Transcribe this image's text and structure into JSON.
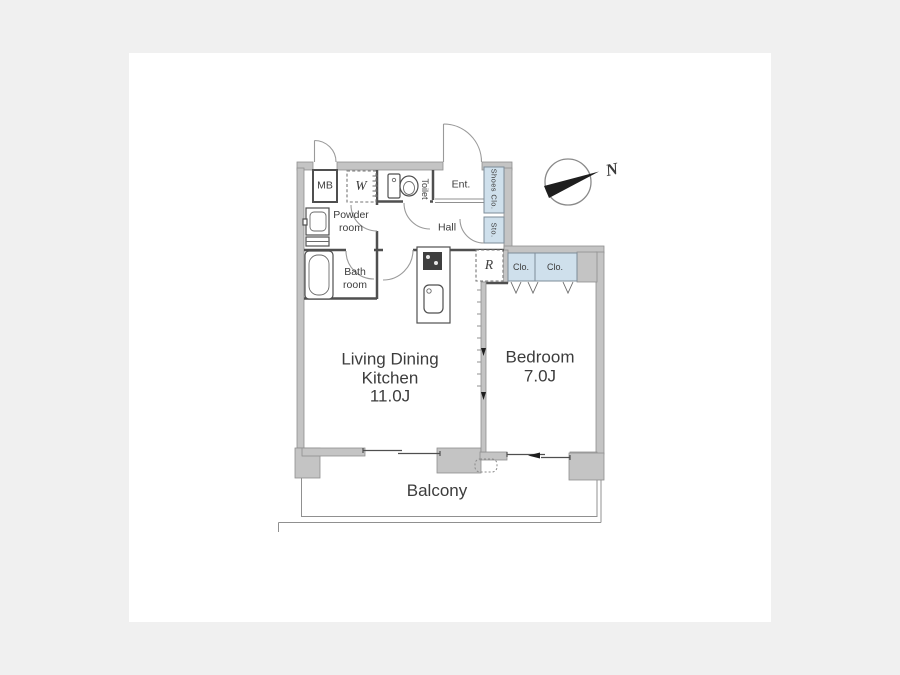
{
  "colors": {
    "bg": "#f0f0f0",
    "canvas": "#ffffff",
    "wall": "#c4c4c4",
    "walledge": "#8f8f8f",
    "line": "#4f4f4f",
    "mid": "#909090",
    "closet": "#cfe0ec",
    "closetedge": "#7d8c99",
    "text": "#3c3c3c",
    "needle": "#1e1e1e"
  },
  "floor_plan": {
    "rooms": {
      "ldk": {
        "line1": "Living Dining",
        "line2": "Kitchen",
        "size": "11.0J"
      },
      "bedroom": {
        "name": "Bedroom",
        "size": "7.0J"
      },
      "balcony": {
        "name": "Balcony"
      },
      "hall": {
        "name": "Hall"
      },
      "entrance": {
        "name": "Ent."
      },
      "toilet": {
        "name": "Toilet"
      },
      "powder_room": {
        "line1": "Powder",
        "line2": "room"
      },
      "bath_room": {
        "line1": "Bath",
        "line2": "room"
      },
      "meter_box": {
        "name": "MB"
      },
      "shoes_closet": {
        "name": "Shoes Clo."
      },
      "storage": {
        "name": "Sto."
      },
      "closet_left": {
        "name": "Clo."
      },
      "closet_right": {
        "name": "Clo."
      },
      "washer": {
        "name": "W"
      },
      "refrigerator": {
        "name": "R"
      }
    },
    "compass": {
      "north": "N"
    }
  }
}
